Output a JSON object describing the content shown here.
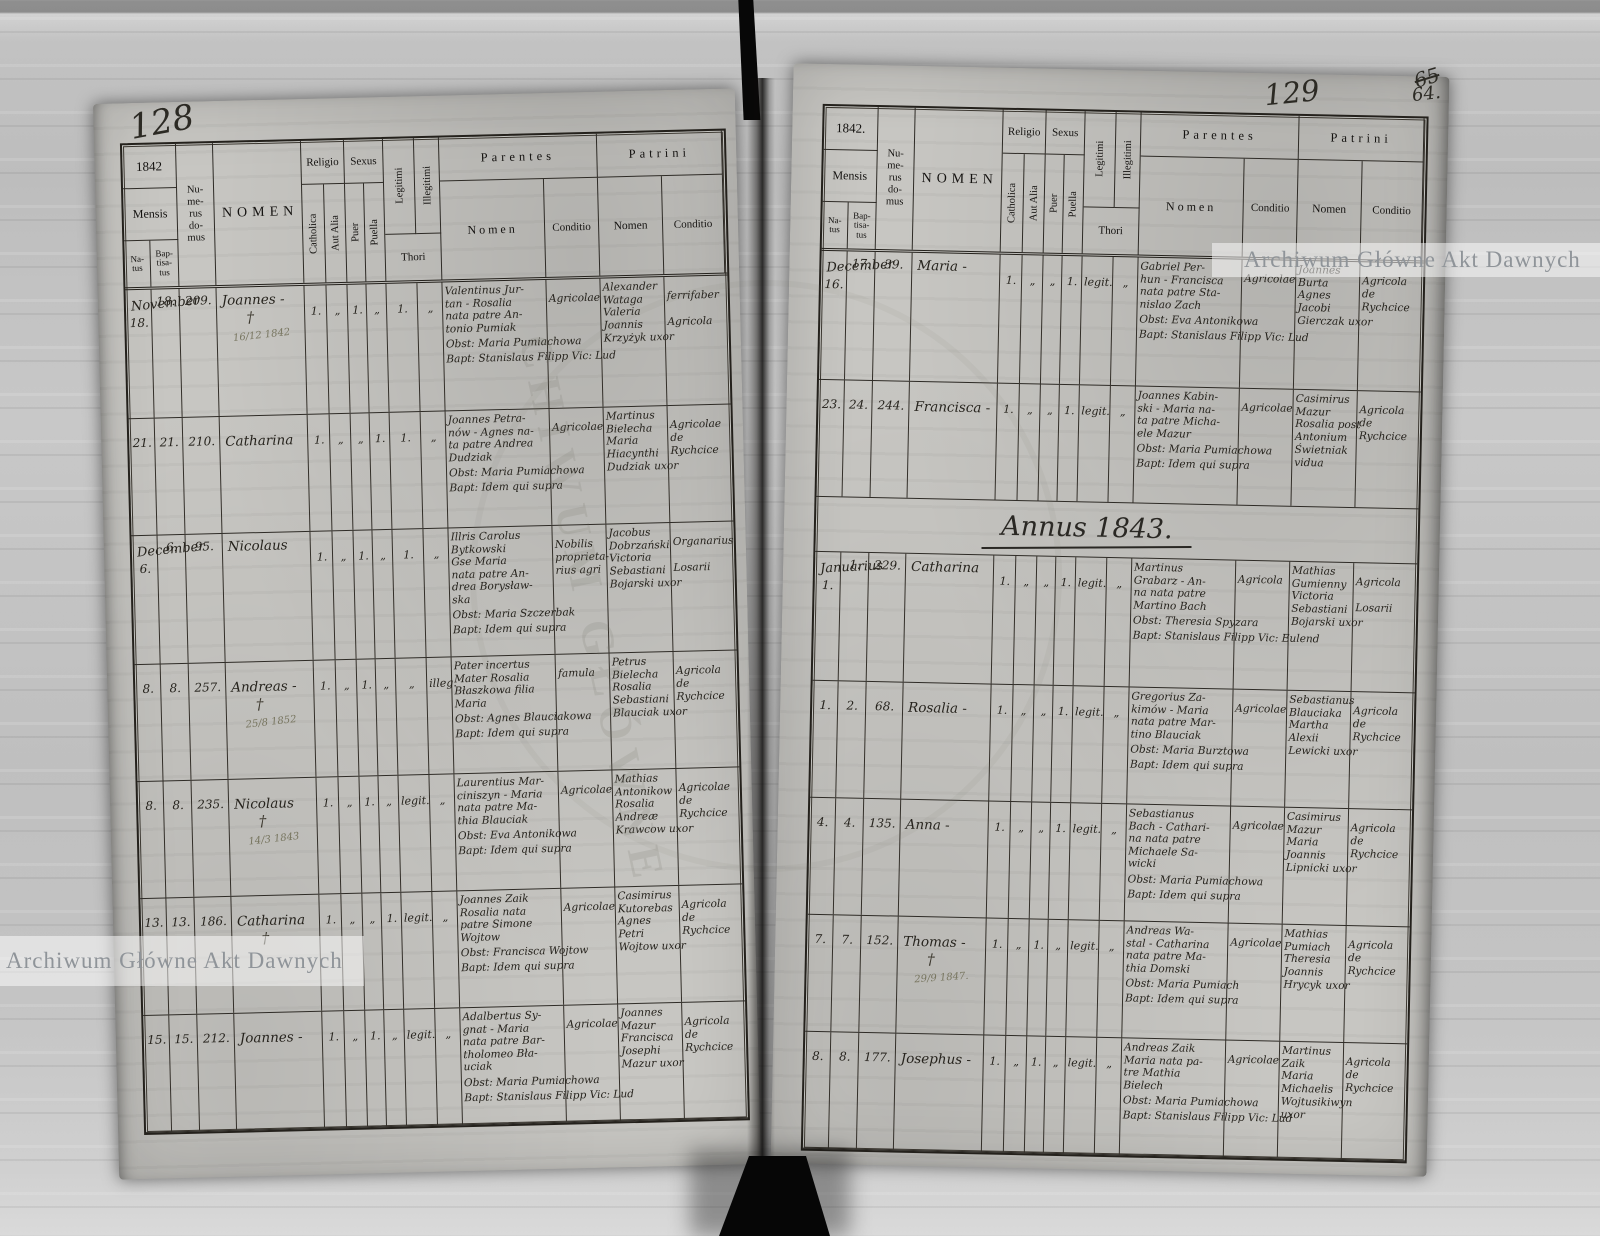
{
  "watermark": {
    "text": "Archiwum Główne Akt Dawnych"
  },
  "folios": {
    "left": "128",
    "right": "129",
    "corner_top": "65",
    "corner": "64."
  },
  "annus_heading": "Annus 1843.",
  "header": {
    "mensis": "Mensis",
    "natus": "Na-\ntus",
    "baptisatus": "Bap-\ntisa-\ntus",
    "numerus": "Nu-\nme-\nrus\ndo-\nmus",
    "nomen": "NOMEN",
    "religio": "Religio",
    "sexus": "Sexus",
    "catholica": "Catholica",
    "aut_alia": "Aut Alia",
    "puer": "Puer",
    "puella": "Puella",
    "legitimi": "Legitimi",
    "illegitimi": "Illegitimi",
    "thori": "Thori",
    "parentes": "Parentes",
    "patrini": "Patrini",
    "sub_nomen": "Nomen",
    "sub_conditio": "Conditio"
  },
  "pages": {
    "left": {
      "year": "1842",
      "rows": [
        {
          "month": "November",
          "natus": "18.",
          "bapt": "18.",
          "num": "209.",
          "name": "Joannes -",
          "cross": "†",
          "note": "16/12 1842",
          "m_cath": "1.",
          "m_aut": "„",
          "m_puer": "1.",
          "m_puella": "„",
          "m_leg": "1.",
          "m_illeg": "„",
          "parents": "Valentinus Jur-\ntan - Rosalia\nnata patre An-\ntonio Pumiak",
          "parents_cond": "Agricolae",
          "obst": "Obst: Maria Pumiachowa",
          "baptline": "Bapt: Stanislaus Filipp Vic: Lud",
          "patrini": "Alexander\nWataga\nValeria\nJoannis\nKrzyżyk uxor",
          "patrini_cond": "ferrifaber\n\nAgricola"
        },
        {
          "natus": "21.",
          "bapt": "21.",
          "num": "210.",
          "name": "Catharina",
          "m_cath": "1.",
          "m_aut": "„",
          "m_puer": "„",
          "m_puella": "1.",
          "m_leg": "1.",
          "m_illeg": "„",
          "parents": "Joannes Petra-\nnów - Agnes na-\nta patre Andrea\nDudziak",
          "parents_cond": "Agricolae",
          "obst": "Obst: Maria Pumiachowa",
          "baptline": "Bapt: Idem qui supra",
          "patrini": "Martinus\nBielecha\nMaria\nHiacynthi\nDudziak uxor",
          "patrini_cond": "Agricolae\nde\nRychcice"
        },
        {
          "month": "December",
          "natus": "6.",
          "bapt": "6.",
          "num": "95.",
          "name": "Nicolaus",
          "m_cath": "1.",
          "m_aut": "„",
          "m_puer": "1.",
          "m_puella": "„",
          "m_leg": "1.",
          "m_illeg": "„",
          "parents": "Illris Carolus\nBytkowski\nGse Maria\nnata patre An-\ndrea Borysław-\nska",
          "parents_cond": "Nobilis\nproprieta-\nrius agri",
          "obst": "Obst: Maria Szczerbak",
          "baptline": "Bapt: Idem qui supra",
          "patrini": "Jacobus\nDobrzański\nVictoria\nSebastiani\nBojarski uxor",
          "patrini_cond": "Organarius\n\nLosarii"
        },
        {
          "natus": "8.",
          "bapt": "8.",
          "num": "257.",
          "name": "Andreas -",
          "cross": "†",
          "note": "25/8 1852",
          "m_cath": "1.",
          "m_aut": "„",
          "m_puer": "1.",
          "m_puella": "„",
          "m_leg": "„",
          "m_illeg": "illeg.",
          "parents": "Pater incertus\nMater Rosalia\nBłaszkowa filia\nMaria",
          "parents_cond": "famula",
          "obst": "Obst: Agnes Blauciakowa",
          "baptline": "Bapt: Idem qui supra",
          "patrini": "Petrus\nBielecha\nRosalia\nSebastiani\nBlauciak uxor",
          "patrini_cond": "Agricola\nde\nRychcice"
        },
        {
          "natus": "8.",
          "bapt": "8.",
          "num": "235.",
          "name": "Nicolaus",
          "cross": "†",
          "note": "14/3 1843",
          "m_cath": "1.",
          "m_aut": "„",
          "m_puer": "1.",
          "m_puella": "„",
          "m_leg": "legit.",
          "m_illeg": "„",
          "parents": "Laurentius Mar-\nciniszyn - Maria\nnata patre Ma-\nthia Blauciak",
          "parents_cond": "Agricolae",
          "obst": "Obst: Eva Antonikowa",
          "baptline": "Bapt: Idem qui supra",
          "patrini": "Mathias\nAntonikow\nRosalia\nAndreæ\nKrawcow uxor",
          "patrini_cond": "Agricolae\nde\nRychcice"
        },
        {
          "natus": "13.",
          "bapt": "13.",
          "num": "186.",
          "name": "Catharina",
          "cross": "†",
          "m_cath": "1.",
          "m_aut": "„",
          "m_puer": "„",
          "m_puella": "1.",
          "m_leg": "legit.",
          "m_illeg": "„",
          "parents": "Joannes Zaik\nRosalia nata\npatre Simone\nWojtow",
          "parents_cond": "Agricolae",
          "obst": "Obst: Francisca Wojtow",
          "baptline": "Bapt: Idem qui supra",
          "patrini": "Casimirus\nKutorebas\nAgnes\nPetri\nWojtow uxor",
          "patrini_cond": "Agricola\nde\nRychcice"
        },
        {
          "natus": "15.",
          "bapt": "15.",
          "num": "212.",
          "name": "Joannes -",
          "m_cath": "1.",
          "m_aut": "„",
          "m_puer": "1.",
          "m_puella": "„",
          "m_leg": "legit.",
          "m_illeg": "„",
          "parents": "Adalbertus Sy-\ngnat - Maria\nnata patre Bar-\ntholomeo Bła-\nuciak",
          "parents_cond": "Agricolae",
          "obst": "Obst: Maria Pumiachowa",
          "baptline": "Bapt: Stanislaus Filipp Vic: Lud",
          "patrini": "Joannes\nMazur\nFrancisca\nJosephi\nMazur uxor",
          "patrini_cond": "Agricola\nde\nRychcice"
        }
      ]
    },
    "right": {
      "year": "1842.",
      "annus_before": 2,
      "rows": [
        {
          "month": "December",
          "natus": "16.",
          "bapt": "17.",
          "num": "39.",
          "name": "Maria -",
          "m_cath": "1.",
          "m_aut": "„",
          "m_puer": "„",
          "m_puella": "1.",
          "m_leg": "legit.",
          "m_illeg": "„",
          "parents": "Gabriel Per-\nhun - Francisca\nnata patre Sta-\nnislao Zach",
          "parents_cond": "Agricolae",
          "obst": "Obst: Eva Antonikowa",
          "baptline": "Bapt: Stanislaus Filipp Vic: Lud",
          "patrini": "Joannes\nBurta\nAgnes\nJacobi\nGierczak uxor",
          "patrini_cond": "Agricola\nde\nRychcice"
        },
        {
          "natus": "23.",
          "bapt": "24.",
          "num": "244.",
          "name": "Francisca -",
          "m_cath": "1.",
          "m_aut": "„",
          "m_puer": "„",
          "m_puella": "1.",
          "m_leg": "legit.",
          "m_illeg": "„",
          "parents": "Joannes Kabin-\nski - Maria na-\nta patre Micha-\nele Mazur",
          "parents_cond": "Agricolae",
          "obst": "Obst: Maria Pumiachowa",
          "baptline": "Bapt: Idem qui supra",
          "patrini": "Casimirus\nMazur\nRosalia post\nAntonium\nŚwietniak vidua",
          "patrini_cond": "Agricola\nde\nRychcice"
        },
        {
          "month": "Januarius",
          "natus": "1.",
          "bapt": "1.",
          "num": "229.",
          "name": "Catharina",
          "m_cath": "1.",
          "m_aut": "„",
          "m_puer": "„",
          "m_puella": "1.",
          "m_leg": "legit.",
          "m_illeg": "„",
          "parents": "Martinus\nGrabarz - An-\nna nata patre\nMartino Bach",
          "parents_cond": "Agricola",
          "obst": "Obst: Theresia Spyzara",
          "baptline": "Bapt: Stanislaus Filipp Vic: Eulend",
          "patrini": "Mathias\nGumienny\nVictoria\nSebastiani\nBojarski uxor",
          "patrini_cond": "Agricola\n\nLosarii"
        },
        {
          "natus": "1.",
          "bapt": "2.",
          "num": "68.",
          "name": "Rosalia -",
          "m_cath": "1.",
          "m_aut": "„",
          "m_puer": "„",
          "m_puella": "1.",
          "m_leg": "legit.",
          "m_illeg": "„",
          "parents": "Gregorius Za-\nkimów - Maria\nnata patre Mar-\ntino Blauciak",
          "parents_cond": "Agricolae",
          "obst": "Obst: Maria Burztowa",
          "baptline": "Bapt: Idem qui supra",
          "patrini": "Sebastianus\nBlauciaka\nMartha\nAlexii\nLewicki uxor",
          "patrini_cond": "Agricola\nde\nRychcice"
        },
        {
          "natus": "4.",
          "bapt": "4.",
          "num": "135.",
          "name": "Anna -",
          "m_cath": "1.",
          "m_aut": "„",
          "m_puer": "„",
          "m_puella": "1.",
          "m_leg": "legit.",
          "m_illeg": "„",
          "parents": "Sebastianus\nBach - Cathari-\nna nata patre\nMichaele Sa-\nwicki",
          "parents_cond": "Agricolae",
          "obst": "Obst: Maria Pumiachowa",
          "baptline": "Bapt: Idem qui supra",
          "patrini": "Casimirus\nMazur\nMaria\nJoannis\nLipnicki uxor",
          "patrini_cond": "Agricola\nde\nRychcice"
        },
        {
          "natus": "7.",
          "bapt": "7.",
          "num": "152.",
          "name": "Thomas -",
          "cross": "†",
          "note": "29/9 1847.",
          "m_cath": "1.",
          "m_aut": "„",
          "m_puer": "1.",
          "m_puella": "„",
          "m_leg": "legit.",
          "m_illeg": "„",
          "parents": "Andreas Wa-\nstal - Catharina\nnata patre Ma-\nthia Domski",
          "parents_cond": "Agricolae",
          "obst": "Obst: Maria Pumiach",
          "baptline": "Bapt: Idem qui supra",
          "patrini": "Mathias\nPumiach\nTheresia\nJoannis\nHrycyk uxor",
          "patrini_cond": "Agricola\nde\nRychcice"
        },
        {
          "natus": "8.",
          "bapt": "8.",
          "num": "177.",
          "name": "Josephus -",
          "m_cath": "1.",
          "m_aut": "„",
          "m_puer": "1.",
          "m_puella": "„",
          "m_leg": "legit.",
          "m_illeg": "„",
          "parents": "Andreas Zaik\nMaria nata pa-\ntre Mathia\nBielech",
          "parents_cond": "Agricolae",
          "obst": "Obst: Maria Pumiachowa",
          "baptline": "Bapt: Stanislaus Filipp Vic: Lud",
          "patrini": "Martinus\nZaik\nMaria\nMichaelis\nWojtusikiwyn uxor",
          "patrini_cond": "Agricola\nde\nRychcice"
        }
      ]
    }
  }
}
